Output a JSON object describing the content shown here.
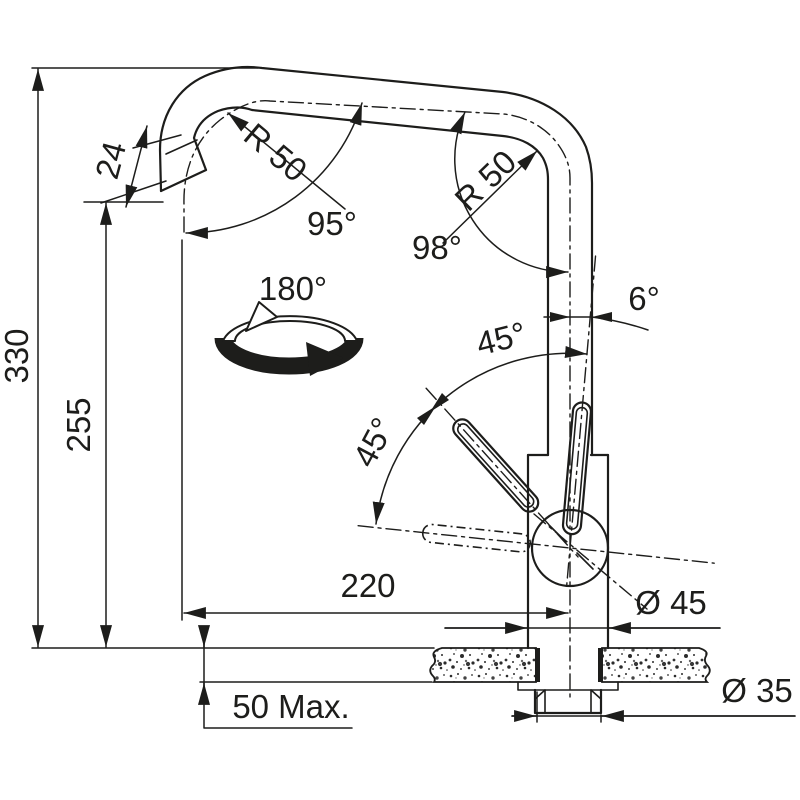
{
  "drawing": {
    "type": "technical-dimension-drawing",
    "subject": "kitchen mixer tap side elevation with installation dimensions",
    "colors": {
      "line": "#1d1d1b",
      "background": "#ffffff"
    },
    "dims": {
      "total_height": "330",
      "outlet_height": "255",
      "spout_tube_diameter": "24",
      "spout_reach": "220",
      "counter_thickness_max": "50 Max.",
      "body_diameter": "Ø 45",
      "hole_diameter": "Ø 35"
    },
    "angles": {
      "left_bend_radius": "R 50",
      "right_bend_radius": "R 50",
      "left_bend_angle": "95°",
      "right_bend_angle": "98°",
      "swivel_range": "180°",
      "handle_tilt": "6°",
      "handle_mid_angle": "45°",
      "handle_low_angle": "45°"
    }
  }
}
